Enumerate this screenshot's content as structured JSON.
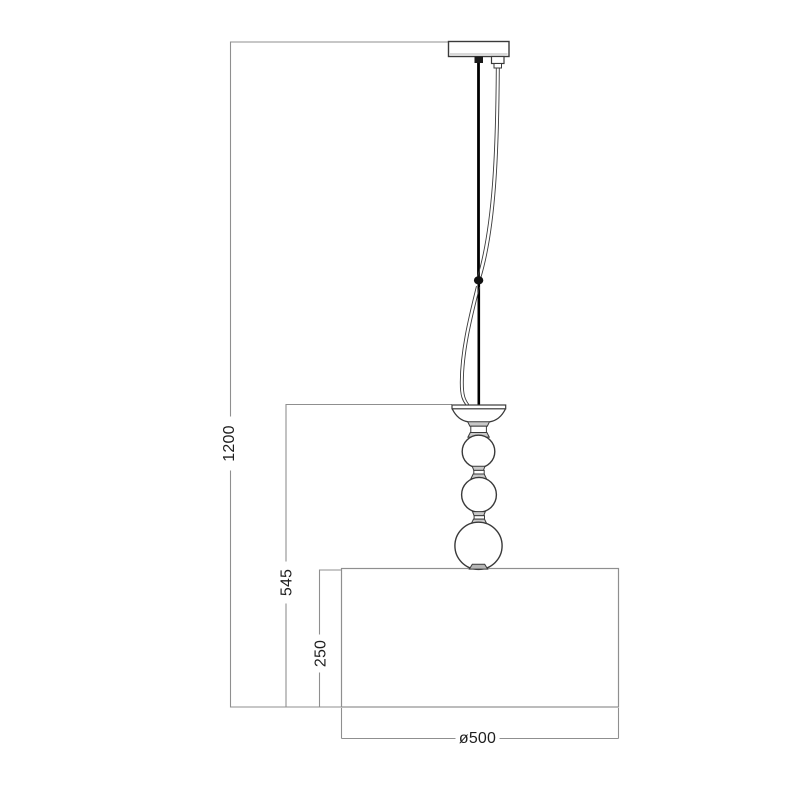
{
  "drawing": {
    "type": "technical-line-drawing",
    "subject": "pendant-lamp-dimension-diagram",
    "colors": {
      "background": "#ffffff",
      "object_line": "#3a3a3a",
      "dimension_line": "#8f8f8f",
      "rod_fill": "#000000",
      "collar_fill": "#c9c9c9",
      "text": "#1f1f1f"
    },
    "labels": {
      "overall_height": "1200",
      "fixture_drop": "545",
      "shade_height": "250",
      "shade_diameter": "ø500"
    },
    "parts": [
      "ceiling-canopy",
      "suspension-rod",
      "power-cable",
      "rod-joint-ferrule",
      "bell-holder",
      "glass-sphere-small",
      "glass-sphere-medium",
      "glass-sphere-large",
      "drum-shade"
    ]
  }
}
